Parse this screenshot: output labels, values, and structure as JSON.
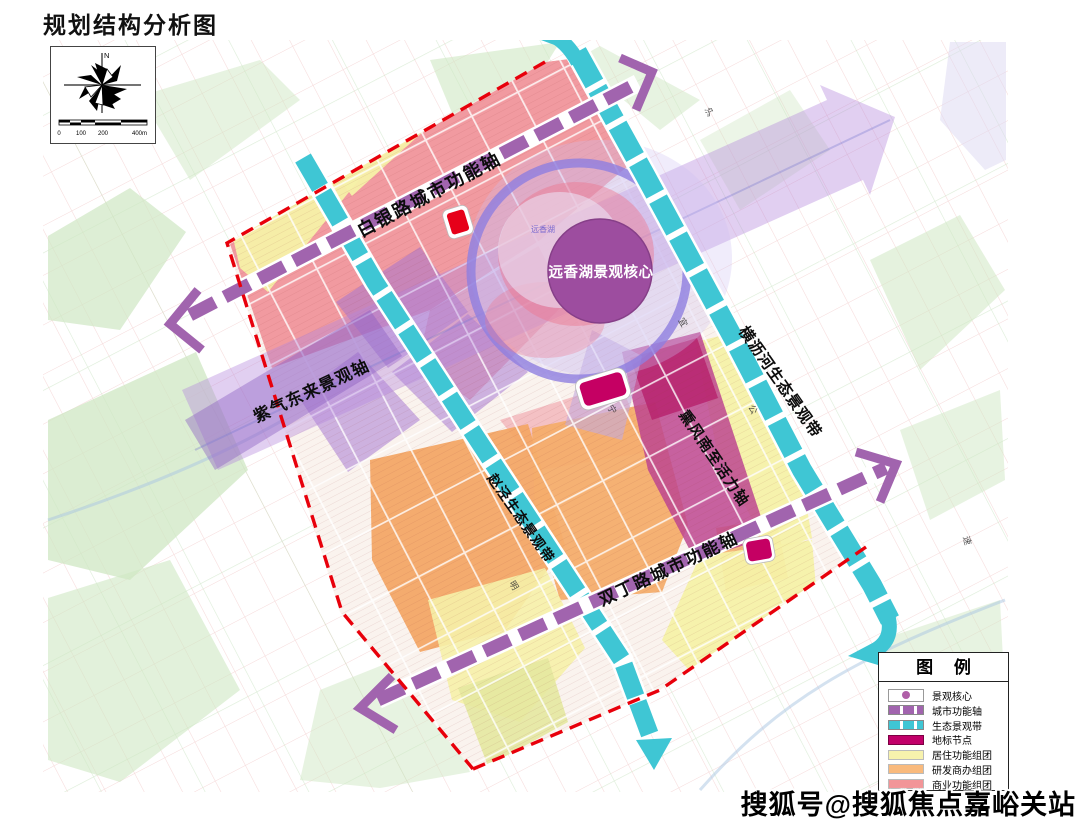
{
  "page": {
    "title": "规划结构分析图",
    "watermark": "搜狐号@搜狐焦点嘉峪关站"
  },
  "compass": {
    "north": "N",
    "scale_ticks": {
      "t0": "0",
      "t1": "100",
      "t2": "200",
      "t3": "400m"
    }
  },
  "map_labels": {
    "core_label": "远香湖景观核心",
    "lake_name": "远香湖",
    "axis_baiyin": "白银路城市功能轴",
    "axis_ziqi": "紫气东来景观轴",
    "axis_xunfeng": "熏风南至活力轴",
    "axis_shuangding": "双丁路城市功能轴",
    "belt_hengli": "横沥河生态景观带",
    "belt_zhaojing": "赵泾生态景观带",
    "micro": {
      "m1": "沪",
      "m2": "宜",
      "m3": "公",
      "m4": "宁",
      "m5": "明",
      "m6": "速"
    }
  },
  "legend": {
    "title": "图 例",
    "items": [
      {
        "label": "景观核心"
      },
      {
        "label": "城市功能轴"
      },
      {
        "label": "生态景观带"
      },
      {
        "label": "地标节点"
      },
      {
        "label": "居住功能组团"
      },
      {
        "label": "研发商办组团"
      },
      {
        "label": "商业功能组团"
      }
    ]
  },
  "colors": {
    "axis_purple": "#a164ae",
    "belt_cyan": "#3fc6d4",
    "node_crimson": "#c2006a",
    "residential_yellow": "#f7f2ad",
    "rnd_orange": "#f9ba7d",
    "commercial_pink": "#f29598",
    "core_purple": "#9d4d9f",
    "boundary_red": "#e8000b"
  }
}
